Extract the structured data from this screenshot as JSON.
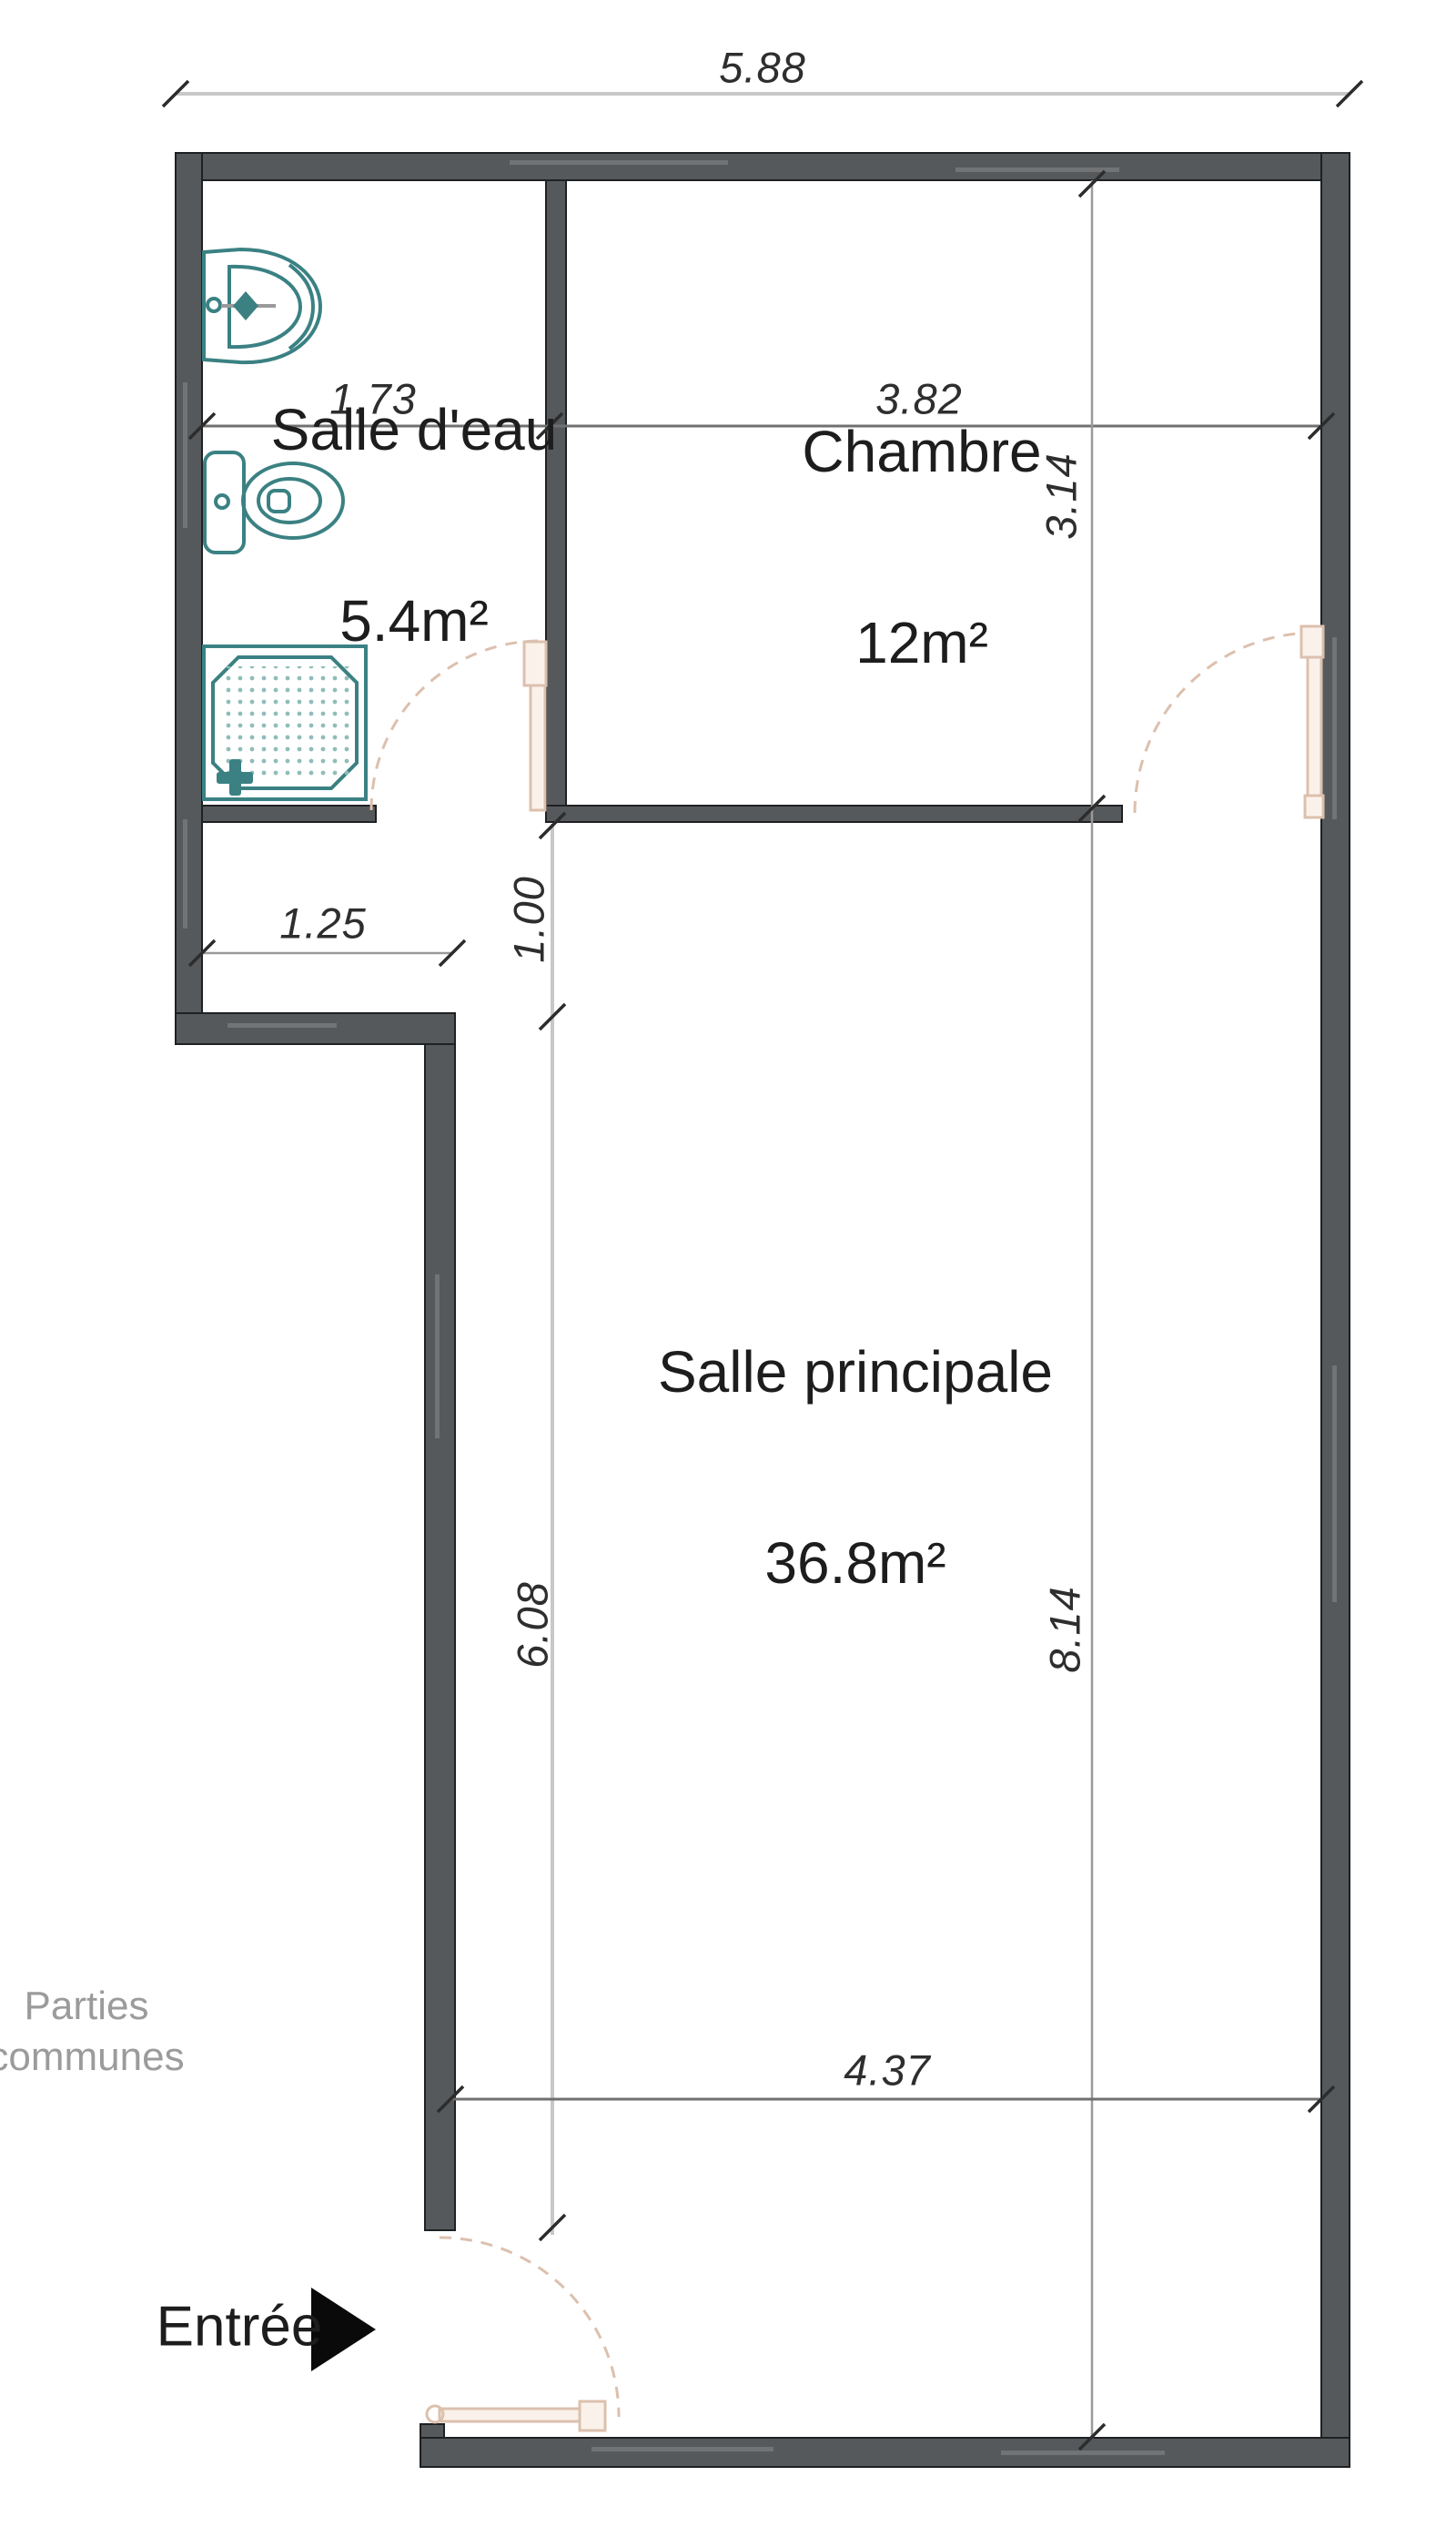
{
  "colors": {
    "wall": "#56595b",
    "wall_edge": "#1f2022",
    "fixture": "#3b8183",
    "fixture_light": "#8fbdb9",
    "door": "#dcc0ae",
    "dim_line": "#9a9a9a",
    "dim_light": "#c8c8c8",
    "dim_dark": "#707070",
    "tick": "#2c2c2c",
    "dim_text": "#2e2e2e",
    "room_text": "#1d1d1d",
    "muted_text": "#9b9b9b",
    "arrow": "#0a0a0a",
    "bg": "#ffffff"
  },
  "rooms": [
    {
      "name": "Salle d'eau",
      "area": "5.4m²"
    },
    {
      "name": "Chambre",
      "area": "12m²"
    },
    {
      "name": "Salle principale",
      "area": "36.8m²"
    }
  ],
  "dimensions": {
    "overall_width": "5.88",
    "salle_deau_width": "1.73",
    "chambre_width": "3.82",
    "chambre_height": "3.14",
    "notch_width": "1.25",
    "passage_height": "1.00",
    "main_room_left_height": "6.08",
    "right_side_height": "8.14",
    "main_room_width": "4.37"
  },
  "labels": {
    "common_areas": "Parties\ncommunes",
    "entrance": "Entrée"
  },
  "fixtures": [
    {
      "icon": "sink-icon",
      "room": "Salle d'eau"
    },
    {
      "icon": "toilet-icon",
      "room": "Salle d'eau"
    },
    {
      "icon": "shower-icon",
      "room": "Salle d'eau"
    }
  ]
}
